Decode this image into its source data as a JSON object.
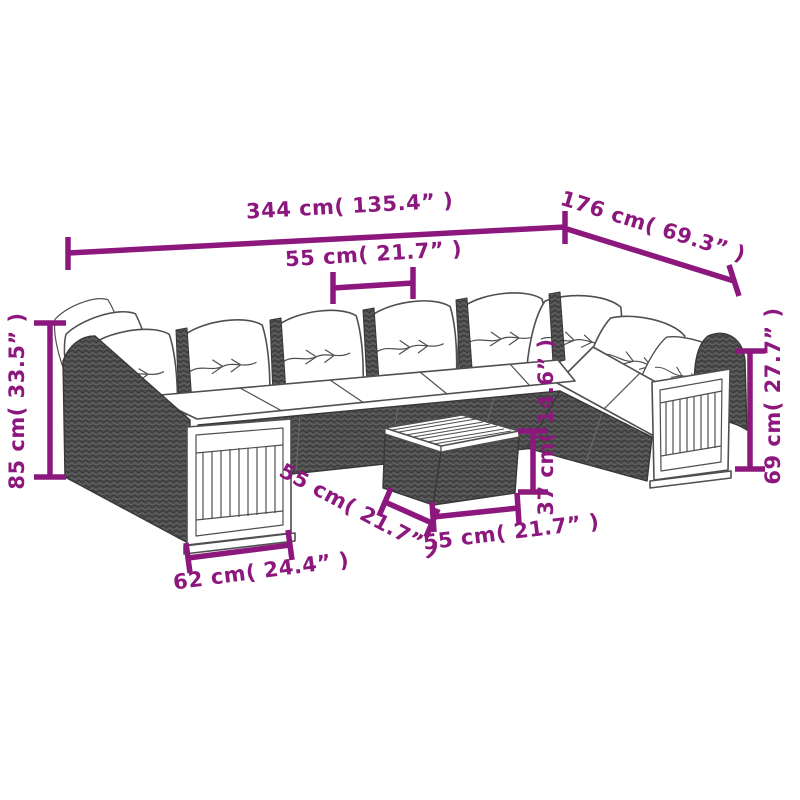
{
  "diagram": {
    "subject": "11 piece rattan garden sofa set with cushions, wood slat panels and coffee table",
    "background": "#ffffff",
    "accent_color": "#8C187E",
    "outline_color": "#4f4f4f",
    "rattan_color": "#4d4d4d",
    "cushion_color": "#ffffff",
    "dimensions": {
      "overall_width": {
        "label": "344 cm( 135.4” )"
      },
      "overall_depth": {
        "label": "176 cm( 69.3” )"
      },
      "seat_module_width": {
        "label": "55 cm( 21.7” )"
      },
      "overall_height": {
        "label": "85 cm( 33.5” )"
      },
      "arm_height": {
        "label": "69 cm( 27.7” )"
      },
      "table_height": {
        "label": "37 cm( 14.6” )"
      },
      "table_depth": {
        "label": "55 cm( 21.7” )"
      },
      "table_width": {
        "label": "55 cm( 21.7” )"
      },
      "end_module_width": {
        "label": "62 cm( 24.4” )"
      }
    }
  }
}
